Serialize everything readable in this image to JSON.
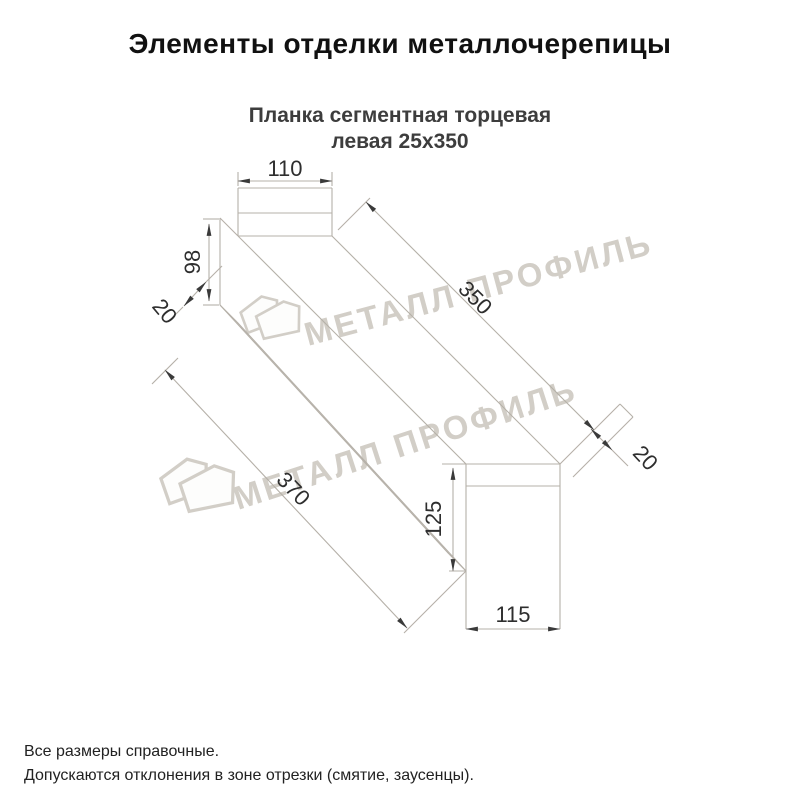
{
  "title": "Элементы отделки металлочерепицы",
  "subtitle": {
    "line1": "Планка сегментная торцевая",
    "line2": "левая 25х350"
  },
  "drawing": {
    "dimensions": {
      "top_width": "110",
      "left_height": "98",
      "left_hem": "20",
      "length_top": "350",
      "length_bottom": "370",
      "end_height": "125",
      "end_width": "115",
      "end_hem": "20"
    }
  },
  "watermark": {
    "text": "МЕТАЛЛ ПРОФИЛЬ"
  },
  "footer": {
    "line1": "Все размеры справочные.",
    "line2": "Допускаются отклонения в зоне отрезки (смятие, заусенцы)."
  },
  "colors": {
    "line": "#b5b0a8",
    "label": "#2e2e2e",
    "watermark": "#d2cec7",
    "title": "#111111",
    "subtitle": "#3d3d3d"
  }
}
